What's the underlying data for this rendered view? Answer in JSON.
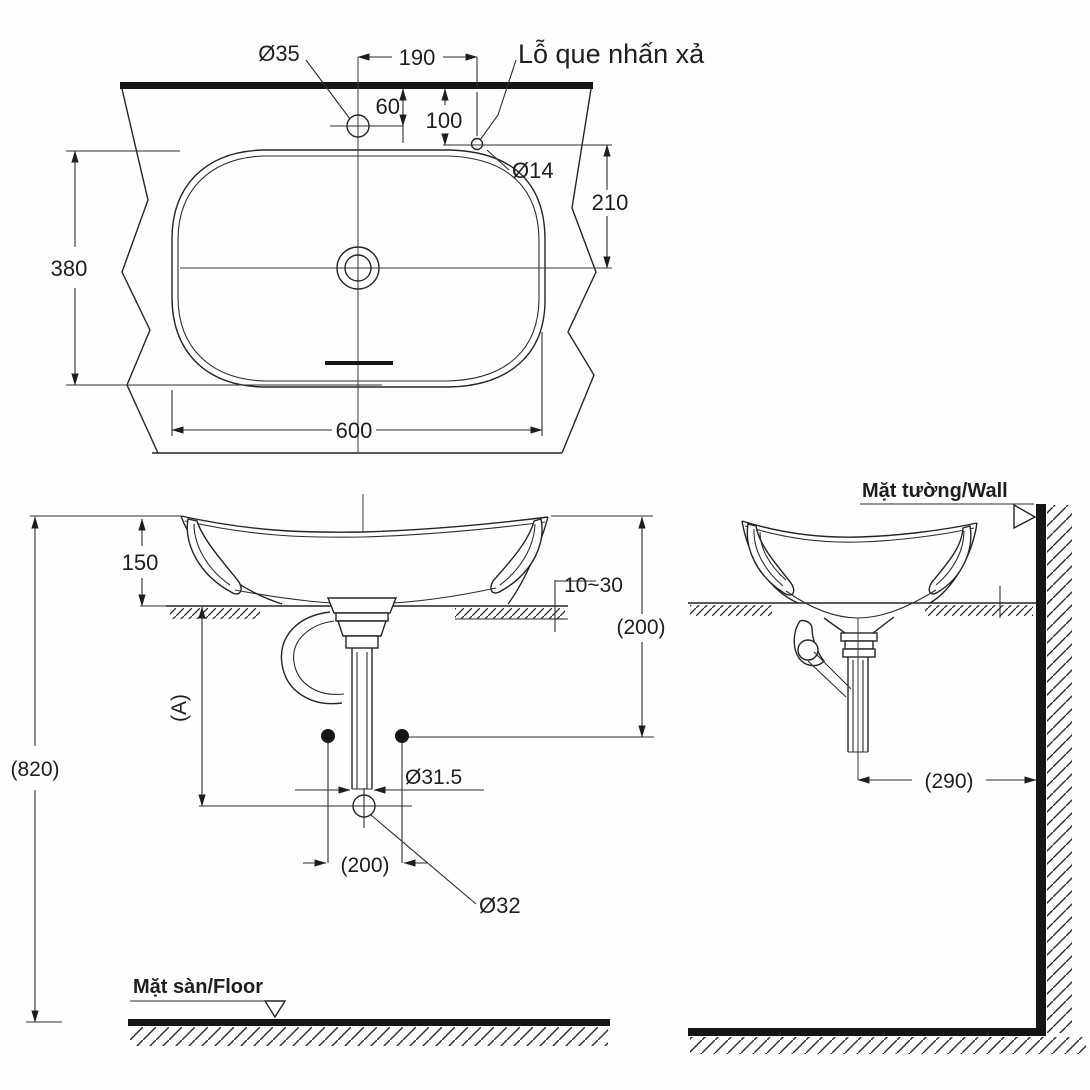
{
  "drawing_type": "basin installation dimension drawing",
  "colors": {
    "ink": "#1e1e1e",
    "background": "#ffffff"
  },
  "views": {
    "top_view": {
      "faucet_hole_diameter": "Ø35",
      "faucet_to_rod_hole_spacing": "190",
      "faucet_center_offset": "60",
      "rod_hole_offset": "100",
      "rod_hole_callout": "Lỗ que nhấn xả",
      "rod_hole_diameter": "Ø14",
      "rod_hole_to_drain_depth": "210",
      "basin_depth": "380",
      "basin_width": "600"
    },
    "front_view": {
      "rim_height_above_counter": "150",
      "counter_thickness_range": "10~30",
      "rim_to_trap_height": "(200)",
      "drain_height_reference": "(A)",
      "rim_height_above_floor": "(820)",
      "drain_pipe_diameter": "Ø31.5",
      "anchor_spacing": "(200)",
      "outlet_hole_diameter": "Ø32",
      "floor_label": "Mặt sàn/Floor"
    },
    "side_view": {
      "wall_label": "Mặt tường/Wall",
      "drain_to_wall_distance": "(290)"
    }
  }
}
